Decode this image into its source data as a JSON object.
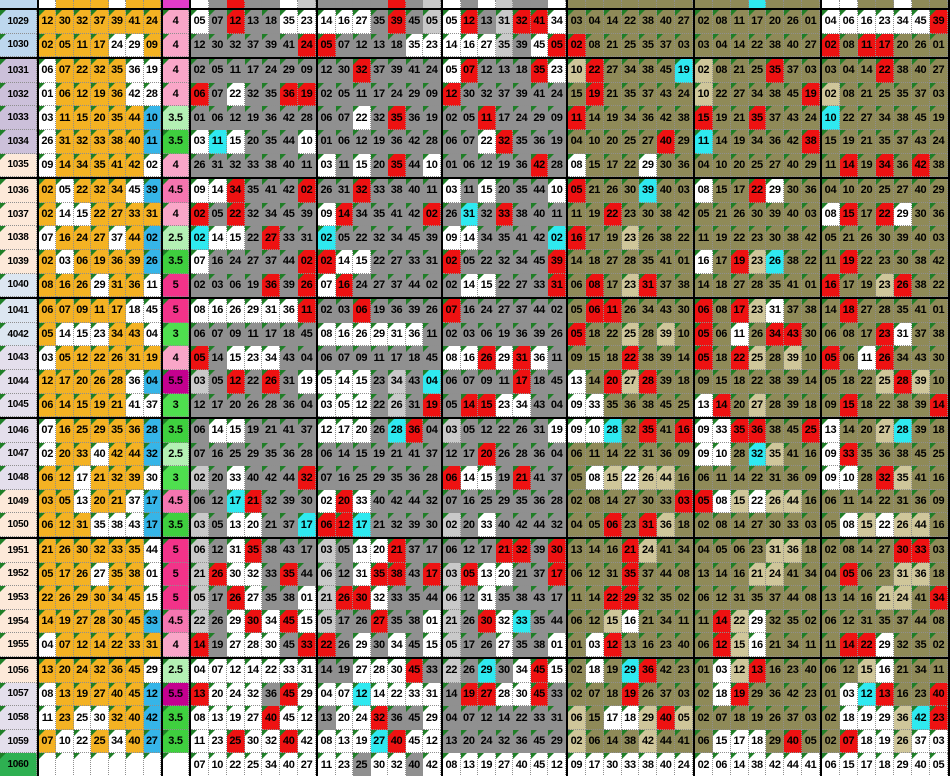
{
  "sheet": {
    "kind": "lottery-draw-comparison-spreadsheet",
    "visible_rows": 32,
    "numbers_per_draw": 7
  },
  "grid": {
    "row_ids": [
      "1029",
      "1030",
      "1031",
      "1032",
      "1033",
      "1034",
      "1035",
      "1036",
      "1037",
      "1038",
      "1039",
      "1040",
      "1041",
      "4042",
      "1043",
      "1044",
      "1045",
      "1046",
      "1047",
      "1048",
      "1049",
      "1050",
      "1951",
      "1952",
      "1953",
      "1954",
      "1955",
      "1056",
      "1057",
      "1058",
      "1059",
      "1060"
    ],
    "row_id_colors": [
      "#bdd7ee",
      "#bdd7ee",
      "#ccc0da",
      "#ccc0da",
      "#ccc0da",
      "#ccc0da",
      "#fde9d9",
      "#fde9d9",
      "#fde9d9",
      "#fde9d9",
      "#fde9d9",
      "#dce6f1",
      "#dce6f1",
      "#dce6f1",
      "#e4dfec",
      "#e4dfec",
      "#e4dfec",
      "#e4dfec",
      "#e4dfec",
      "#e4dfec",
      "#fde9d9",
      "#fde9d9",
      "#fde9d9",
      "#fde9d9",
      "#fde9d9",
      "#fde9d9",
      "#fde9d9",
      "#fde9d9",
      "#e4dfec",
      "#e4dfec",
      "#e4dfec",
      "#2eb051"
    ],
    "values": [
      "4",
      "4",
      "4",
      "4",
      "3.5",
      "3.5",
      "4",
      "4.5",
      "4",
      "2.5",
      "3.5",
      "5",
      "5",
      "3",
      "4",
      "5.5",
      "3",
      "3.5",
      "2.5",
      "3",
      "4.5",
      "3.5",
      "5",
      "5",
      "5",
      "4.5",
      "4",
      "2.5",
      "5.5",
      "3.5",
      "3.5",
      ""
    ],
    "value_colors": [
      "#f9a6c8",
      "#f9a6c8",
      "#f9a6c8",
      "#f9a6c8",
      "#b4f0b4",
      "#3fd03f",
      "#f9a6c8",
      "#f576b0",
      "#f9a6c8",
      "#b4f0b4",
      "#3fd03f",
      "#f23389",
      "#f23389",
      "#4fdf4f",
      "#f9a6c8",
      "#c4008f",
      "#4fdf4f",
      "#3fd03f",
      "#b4f0b4",
      "#4fdf4f",
      "#f576b0",
      "#3fd03f",
      "#f23389",
      "#f23389",
      "#f23389",
      "#f576b0",
      "#f9a6c8",
      "#b4f0b4",
      "#c4008f",
      "#3fd03f",
      "#3fd03f",
      "#ffffff"
    ],
    "masterA": [
      [
        "05",
        "12",
        "13",
        "31",
        "32",
        "41",
        "34"
      ],
      [
        "14",
        "16",
        "27",
        "35",
        "39",
        "45",
        "05"
      ],
      [
        "05",
        "07",
        "12",
        "13",
        "18",
        "35",
        "23"
      ],
      [
        "12",
        "30",
        "32",
        "37",
        "39",
        "41",
        "24"
      ],
      [
        "02",
        "05",
        "11",
        "17",
        "24",
        "29",
        "09"
      ],
      [
        "06",
        "07",
        "22",
        "32",
        "35",
        "36",
        "19"
      ],
      [
        "01",
        "06",
        "12",
        "19",
        "36",
        "42",
        "28"
      ],
      [
        "03",
        "11",
        "15",
        "20",
        "35",
        "44",
        "10"
      ],
      [
        "26",
        "31",
        "32",
        "33",
        "38",
        "40",
        "11"
      ],
      [
        "09",
        "14",
        "34",
        "35",
        "41",
        "42",
        "02"
      ],
      [
        "02",
        "05",
        "22",
        "32",
        "34",
        "45",
        "39"
      ],
      [
        "02",
        "14",
        "15",
        "22",
        "27",
        "33",
        "31"
      ],
      [
        "07",
        "16",
        "24",
        "27",
        "37",
        "44",
        "02"
      ],
      [
        "02",
        "03",
        "06",
        "19",
        "36",
        "39",
        "26"
      ],
      [
        "08",
        "16",
        "26",
        "29",
        "31",
        "36",
        "11"
      ],
      [
        "06",
        "07",
        "09",
        "11",
        "17",
        "18",
        "45"
      ],
      [
        "05",
        "14",
        "15",
        "23",
        "34",
        "43",
        "04"
      ],
      [
        "03",
        "05",
        "12",
        "22",
        "26",
        "31",
        "19"
      ],
      [
        "12",
        "17",
        "20",
        "26",
        "28",
        "36",
        "04"
      ],
      [
        "06",
        "14",
        "15",
        "19",
        "21",
        "41",
        "37"
      ],
      [
        "07",
        "16",
        "25",
        "29",
        "35",
        "36",
        "28"
      ],
      [
        "02",
        "20",
        "33",
        "40",
        "42",
        "44",
        "32"
      ],
      [
        "06",
        "12",
        "17",
        "21",
        "32",
        "39",
        "30"
      ],
      [
        "03",
        "05",
        "13",
        "20",
        "21",
        "37",
        "17"
      ],
      [
        "06",
        "12",
        "31",
        "35",
        "38",
        "43",
        "17"
      ],
      [
        "21",
        "26",
        "30",
        "32",
        "33",
        "35",
        "44"
      ],
      [
        "05",
        "17",
        "26",
        "27",
        "35",
        "38",
        "01"
      ],
      [
        "22",
        "26",
        "29",
        "30",
        "34",
        "45",
        "15"
      ],
      [
        "14",
        "19",
        "27",
        "28",
        "30",
        "45",
        "33"
      ],
      [
        "04",
        "07",
        "12",
        "14",
        "22",
        "33",
        "31"
      ],
      [
        "13",
        "20",
        "24",
        "32",
        "36",
        "45",
        "29"
      ],
      [
        "08",
        "13",
        "19",
        "27",
        "40",
        "45",
        "12"
      ],
      [
        "11",
        "23",
        "25",
        "30",
        "32",
        "40",
        "42"
      ],
      [
        "07",
        "10",
        "22",
        "25",
        "34",
        "40",
        "27"
      ]
    ],
    "masterB": [
      [
        "04",
        "06",
        "16",
        "23",
        "34",
        "45",
        "39"
      ],
      [
        "02",
        "08",
        "11",
        "17",
        "20",
        "26",
        "01"
      ],
      [
        "03",
        "04",
        "14",
        "22",
        "38",
        "40",
        "27"
      ],
      [
        "02",
        "08",
        "21",
        "25",
        "35",
        "37",
        "03"
      ],
      [
        "10",
        "22",
        "27",
        "34",
        "38",
        "45",
        "19"
      ],
      [
        "15",
        "19",
        "21",
        "35",
        "37",
        "43",
        "24"
      ],
      [
        "11",
        "14",
        "19",
        "34",
        "36",
        "42",
        "38"
      ],
      [
        "04",
        "10",
        "20",
        "25",
        "27",
        "40",
        "29"
      ],
      [
        "08",
        "15",
        "17",
        "22",
        "29",
        "30",
        "36"
      ],
      [
        "05",
        "21",
        "26",
        "30",
        "39",
        "40",
        "03"
      ],
      [
        "11",
        "19",
        "22",
        "23",
        "30",
        "38",
        "42"
      ],
      [
        "16",
        "17",
        "19",
        "23",
        "26",
        "38",
        "22"
      ],
      [
        "14",
        "18",
        "27",
        "28",
        "35",
        "41",
        "01"
      ],
      [
        "06",
        "08",
        "17",
        "23",
        "31",
        "37",
        "38"
      ],
      [
        "05",
        "06",
        "11",
        "26",
        "34",
        "43",
        "30"
      ],
      [
        "05",
        "18",
        "22",
        "25",
        "28",
        "39",
        "10"
      ],
      [
        "09",
        "15",
        "18",
        "22",
        "38",
        "39",
        "14"
      ],
      [
        "13",
        "14",
        "20",
        "27",
        "28",
        "39",
        "18"
      ],
      [
        "09",
        "33",
        "35",
        "36",
        "38",
        "45",
        "25"
      ],
      [
        "09",
        "10",
        "28",
        "32",
        "35",
        "41",
        "16"
      ],
      [
        "06",
        "11",
        "14",
        "22",
        "31",
        "36",
        "09"
      ],
      [
        "05",
        "08",
        "15",
        "22",
        "26",
        "44",
        "16"
      ],
      [
        "02",
        "08",
        "14",
        "27",
        "30",
        "33",
        "03"
      ],
      [
        "04",
        "05",
        "06",
        "23",
        "31",
        "36",
        "18"
      ],
      [
        "13",
        "14",
        "16",
        "21",
        "24",
        "41",
        "34"
      ],
      [
        "06",
        "12",
        "31",
        "35",
        "37",
        "44",
        "08"
      ],
      [
        "11",
        "14",
        "22",
        "29",
        "32",
        "35",
        "02"
      ],
      [
        "06",
        "12",
        "15",
        "16",
        "21",
        "34",
        "11"
      ],
      [
        "01",
        "03",
        "12",
        "13",
        "16",
        "23",
        "40"
      ],
      [
        "02",
        "18",
        "19",
        "29",
        "36",
        "42",
        "23"
      ],
      [
        "02",
        "07",
        "18",
        "19",
        "26",
        "37",
        "03"
      ],
      [
        "06",
        "15",
        "17",
        "18",
        "29",
        "40",
        "05"
      ],
      [
        "02",
        "06",
        "14",
        "38",
        "42",
        "44",
        "41"
      ],
      [
        "09",
        "17",
        "30",
        "33",
        "38",
        "40",
        "24"
      ]
    ],
    "masterA_pattern": [
      "WGGLGGW",
      "WWWGGGL",
      "WGGGGWW",
      "GGGGGGG",
      "GGGGGGG",
      "GGWGGGG",
      "GGGGGGG",
      "WGWGGGW",
      "GGGGGGG",
      "WWGGGGG",
      "GGGGGGG",
      "GWWGGGG",
      "WGGGGGG",
      "GGGGGGG",
      "WWWWWWG",
      "GGGGGGG",
      "GGWWWGG",
      "LGGGGGW",
      "GGGGGGG",
      "GWWGGGG",
      "GGGGGGG",
      "LGWGGGG",
      "GGGGGGG",
      "LGWWGGG",
      "LGWGGGG",
      "LGWWGGG",
      "LGGWGGW",
      "LGWGWGW",
      "GGWWWGG",
      "WWWWWWW",
      "GWWWGGW",
      "WWWWGWW",
      "WWGWWGW",
      "WWWWWWW"
    ],
    "masterB_pattern": [
      "WWWWWWW",
      "TTTTTTT",
      "TTTTTTT",
      "LTTTTTT",
      "LTTTTTT",
      "TTTTTTT",
      "TTTTTTT",
      "TTTTTTT",
      "WTTTWTT",
      "TTTTTTT",
      "TTTTTTT",
      "WTTLTTT",
      "TTTTTTT",
      "TTTLWTT",
      "TTWTTTT",
      "TTTLTLT",
      "TTTTTTT",
      "WTTLTTT",
      "WWTTTTT",
      "WWTTLTT",
      "TTTTTTT",
      "TWLWLLT",
      "TTTTTTT",
      "TTTTLLT",
      "TTTLLTT",
      "TTTTTTT",
      "TTLWTTT",
      "TTLWTTT",
      "TWLTTTT",
      "TWTTTTT",
      "TTTTTTT",
      "TWWWTTT",
      "WWWWWWW",
      "WWWWWWW"
    ],
    "yellow_pattern": [
      "OOOOOOO",
      "OOOOWWO",
      "WOOOOWW",
      "WOOOOWW",
      "WOOOOOC",
      "WOOOOOC",
      "WOOOOOW",
      "OWOOOWC",
      "OWWOOOO",
      "WOOOWOC",
      "OWOOOOC",
      "OOOWOOW",
      "OOOOOWW",
      "OWWWOOW",
      "WOOOOOO",
      "OOOOOWC",
      "OOOOOWW",
      "WOOOOOC",
      "WOOWOOC",
      "OOWOOOW",
      "OOWOOWC",
      "OOOWWWC",
      "OOOOOOW",
      "OOOWOOW",
      "OOOOOOW",
      "OOOOOOC",
      "WOOOOOO",
      "OOOOOOW",
      "WOOOOOC",
      "WOWWOOC",
      "OWWOWOC",
      "-------"
    ],
    "pattern_overrides": {
      "b3:15": "WWWGLGG",
      "b3:16": "WWWGLGG",
      "b3:17": "WWWGGGG",
      "b3:18": "GGGGGGG",
      "b3:19": "GGGGGGG",
      "b3:20": "WGWGGGG",
      "b3:21": "GGGGGGG",
      "b4:1": "WWWLGWG",
      "b4:29": "GGGGGGG",
      "b4:30": "GGGGGGG",
      "b4:31": "WWWWWWW",
      "b5:29": "LTWWLTL",
      "b5:30": "LTTTLTT",
      "b7:29": "TWWWLTT",
      "b7:30": "TTWWLWW",
      "b7:31": "WWWWWWW"
    },
    "red_exceptions": [
      "b6:19:0"
    ],
    "blocks": [
      {
        "key": "b1",
        "family": "yellow",
        "source": "A",
        "shift": 0,
        "width": 124
      },
      {
        "key": "b2",
        "family": "gray",
        "source": "A",
        "shift": 1,
        "width": 127
      },
      {
        "key": "b3",
        "family": "gray",
        "source": "A",
        "shift": 2,
        "width": 125
      },
      {
        "key": "b4",
        "family": "gray",
        "source": "A",
        "shift": 3,
        "width": 125
      },
      {
        "key": "b5",
        "family": "tan",
        "source": "B",
        "shift": 4,
        "width": 127
      },
      {
        "key": "b6",
        "family": "tan",
        "source": "B",
        "shift": 5,
        "width": 127
      },
      {
        "key": "b7",
        "family": "tan",
        "source": "B",
        "shift": 6,
        "width": 130
      }
    ],
    "colors": {
      "orange": "#f4b223",
      "white": "#ffffff",
      "bonus_blue": "#36b5e8",
      "cyan": "#2fe9f0",
      "red": "#ee1212",
      "gray": "#909090",
      "light_gray": "#c9c9c9",
      "tan": "#8f8a58",
      "light_tan": "#cfc69a",
      "id_width": 37,
      "value_width": 28,
      "row_height": 23.6,
      "sliver_height": 8,
      "triangle": "#1f7f27"
    },
    "sliver": {
      "id": "#bdd7ee",
      "value": "#e23cc8",
      "blocks": {
        "b1": [
          "W",
          "O",
          "O",
          "O",
          "W",
          "O",
          "O"
        ],
        "b2": [
          "W",
          "G",
          "R",
          "G",
          "G",
          "W",
          "L"
        ],
        "b3": [
          "G",
          "G",
          "G",
          "G",
          "R",
          "G",
          "L"
        ],
        "b4": [
          "W",
          "G",
          "W",
          "L",
          "G",
          "G",
          "W"
        ],
        "b5": [
          "T",
          "T",
          "T",
          "T",
          "T",
          "T",
          "T"
        ],
        "b6": [
          "T",
          "T",
          "T",
          "C",
          "T",
          "T",
          "T"
        ],
        "b7": [
          "W",
          "W",
          "T",
          "T",
          "W",
          "T",
          "T"
        ]
      }
    }
  }
}
